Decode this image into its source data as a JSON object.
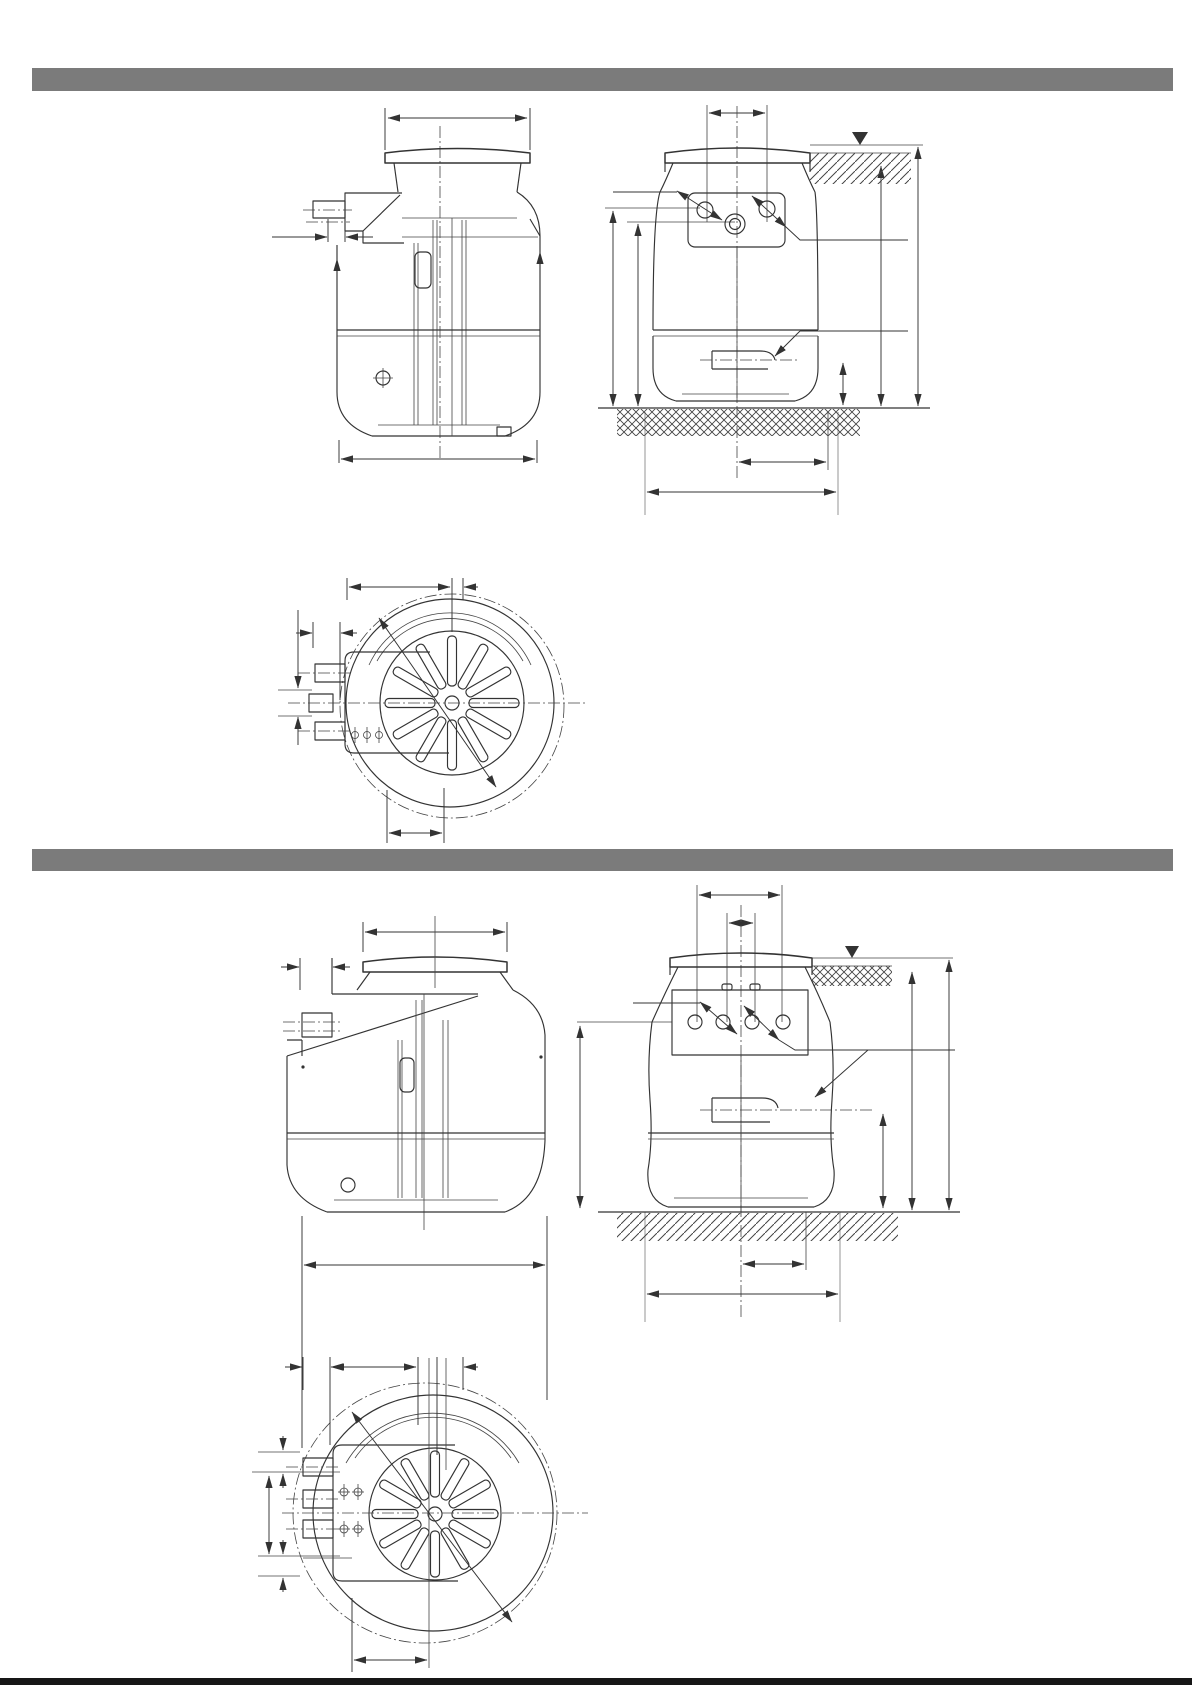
{
  "page": {
    "width_px": 1192,
    "height_px": 1685,
    "background": "#ffffff"
  },
  "section_bars": {
    "color": "#7b7b7b",
    "count": 2,
    "text": ""
  },
  "footer_bar": {
    "color": "#161616"
  },
  "drawing": {
    "line_color": "#333333",
    "light_line_color": "#9f9f9f",
    "symbols": {
      "groundwater_level": "filled-triangle-down",
      "earth_top": "diagonal-hatch",
      "earth_bottom": "diamond-crosshatch"
    },
    "views": [
      {
        "id": "upper-side-view",
        "type": "side elevation of buried sump tank with inlet stub"
      },
      {
        "id": "upper-front-view",
        "type": "front elevation with connection plate, groundwater level and earth hatching"
      },
      {
        "id": "upper-plan-view",
        "type": "plan view with spoked cover and pit circle"
      },
      {
        "id": "lower-side-view",
        "type": "side elevation of larger sump tank with inlet stub"
      },
      {
        "id": "lower-front-view",
        "type": "front elevation with four-hole connection plate, groundwater level and earth hatching"
      },
      {
        "id": "lower-plan-view",
        "type": "plan view with spoked cover and pit ellipse"
      }
    ],
    "dimension_labels": []
  }
}
